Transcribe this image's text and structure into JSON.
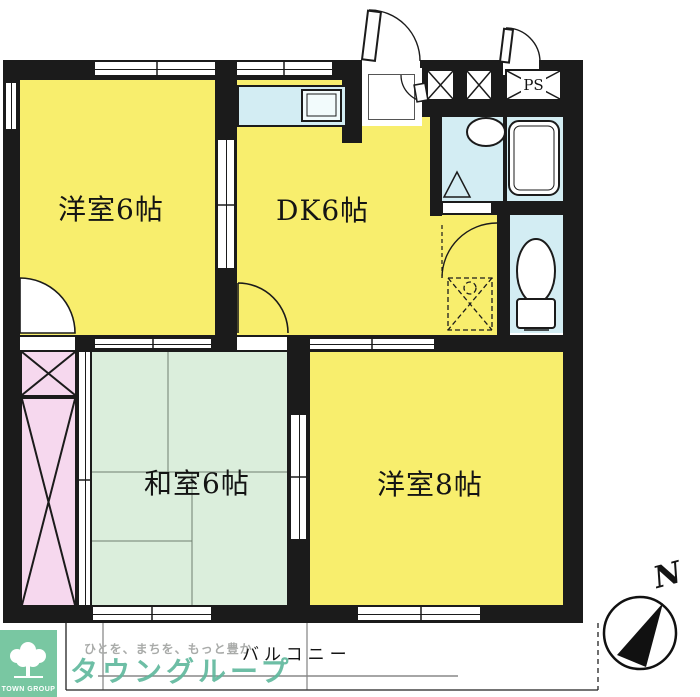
{
  "colors": {
    "wall": "#1b1b1b",
    "room-yellow": "#f8ee6d",
    "tatami-green": "#dbeedc",
    "closet-pink": "#f6d8ee",
    "wet-blue": "#d3edf3",
    "logo-green": "#79c7a2",
    "brand-green": "#5eb89c",
    "tagline-gray": "#a9aba9"
  },
  "rooms": {
    "west6": {
      "label": "洋室6帖"
    },
    "dk": {
      "label": "DK6帖"
    },
    "west8": {
      "label": "洋室8帖"
    },
    "tatami": {
      "label": "和室6帖"
    }
  },
  "annotations": {
    "pipe_shaft": "PS",
    "balcony": "バルコニー",
    "compass_north": "N"
  },
  "branding": {
    "tagline": "ひとを、まちを、もっと豊か",
    "company": "タウングループ",
    "logo_caption": "TOWN GROUP"
  }
}
